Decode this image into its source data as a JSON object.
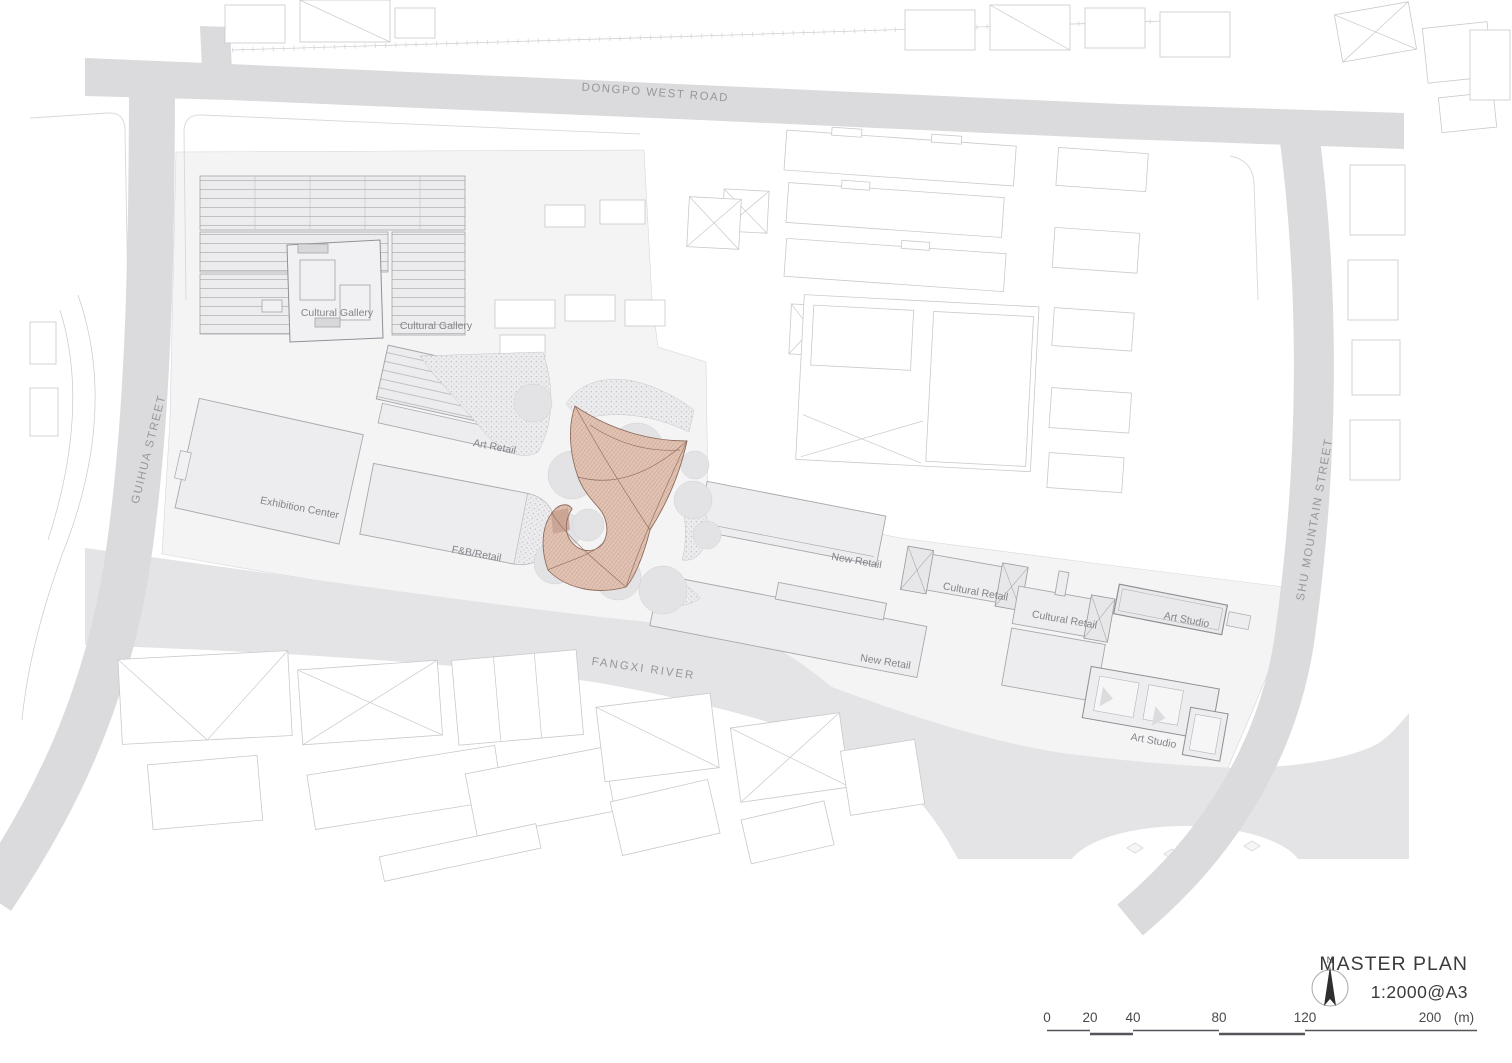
{
  "map": {
    "roads": {
      "dongpo_west_road": "DONGPO WEST ROAD",
      "guihua_street": "GUIHUA STREET",
      "shu_mountain_street": "SHU MOUNTAIN STREET"
    },
    "river": {
      "name": "FANGXI RIVER"
    },
    "buildings": {
      "cultural_gallery_1": "Cultural Gallery",
      "cultural_gallery_2": "Cultural Gallery",
      "art_retail": "Art Retail",
      "exhibition_center": "Exhibition Center",
      "fnb_retail": "F&B/Retail",
      "new_retail_1": "New Retail",
      "new_retail_2": "New Retail",
      "cultural_retail_1": "Cultural Retail",
      "cultural_retail_2": "Cultural Retail",
      "art_studio_1": "Art Studio",
      "art_studio_2": "Art Studio"
    }
  },
  "title_block": {
    "title": "MASTER PLAN",
    "scale_text": "1:2000@A3",
    "north_label": "N"
  },
  "scale_bar": {
    "tick_labels": [
      "0",
      "20",
      "40",
      "80",
      "120",
      "200"
    ],
    "unit_label": "(m)",
    "tick_values_m": [
      0,
      20,
      40,
      80,
      120,
      200
    ]
  },
  "colors": {
    "road": "#dbdbde",
    "river": "#e4e4e6",
    "site_ground": "#f4f4f5",
    "building_fill": "#ededef",
    "tree": "#e3e3e5",
    "pavilion_fill": "#e2c4b5",
    "pavilion_line": "#8f6d5e",
    "context_outline": "#c9c9cd",
    "label_text": "#84848a",
    "title_text": "#3b3b3d"
  }
}
